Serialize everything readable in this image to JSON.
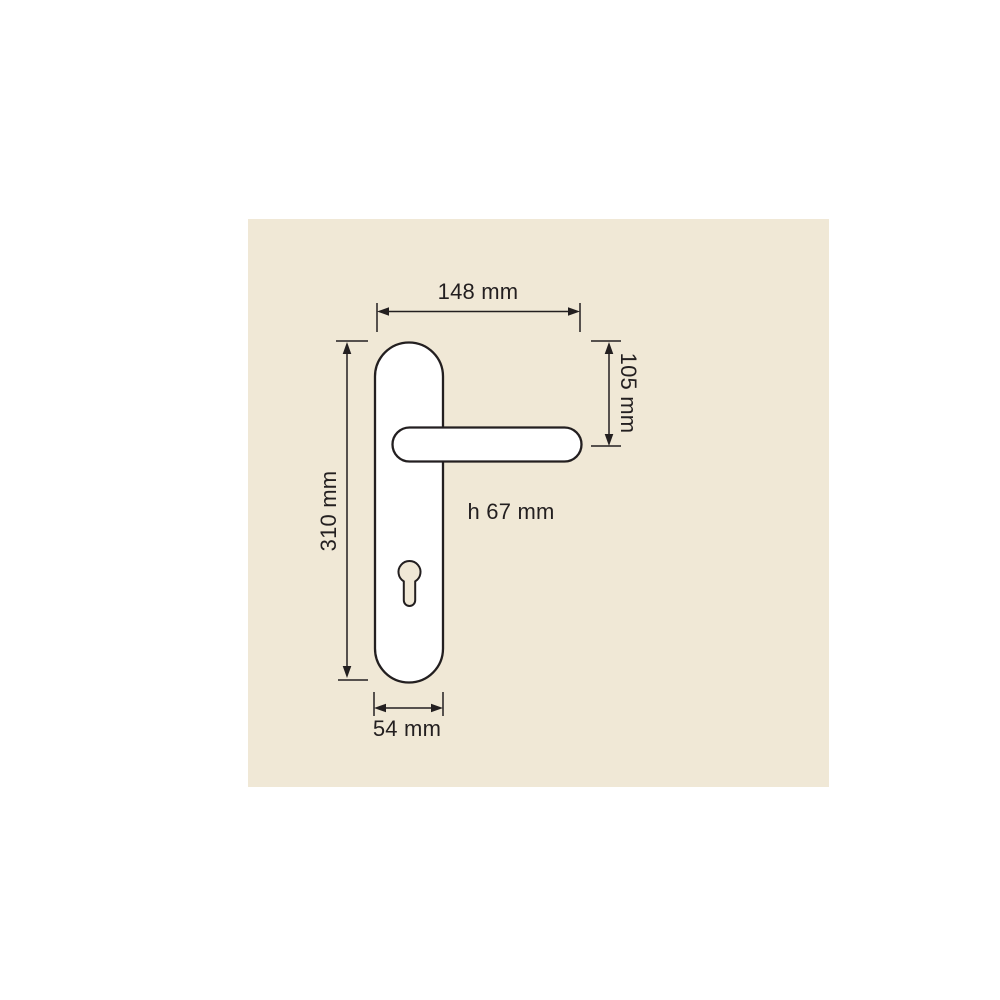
{
  "colors": {
    "page_bg": "#ffffff",
    "panel_bg": "#f0e8d6",
    "line": "#231f20",
    "text": "#231f20",
    "shape_fill": "#ffffff"
  },
  "diagram": {
    "subject": "door-handle-on-backplate-technical-drawing",
    "dimensions": {
      "overall_width": "148 mm",
      "handle_drop": "105 mm",
      "plate_height": "310 mm",
      "plate_width": "54 mm",
      "handle_height": "h 67 mm"
    }
  }
}
